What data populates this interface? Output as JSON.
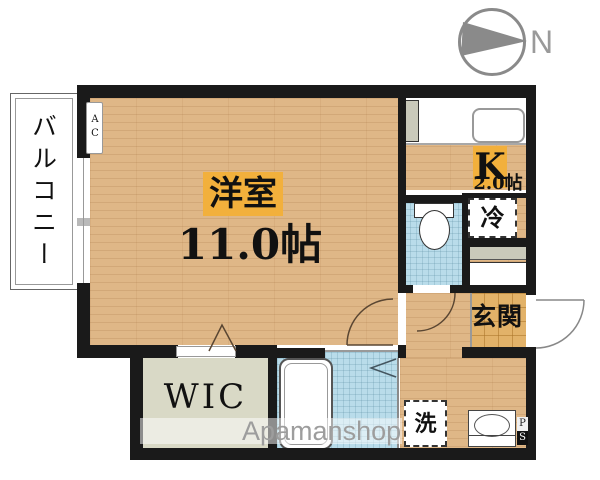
{
  "compass": {
    "north": "N"
  },
  "watermark": {
    "text": "Apamanshop"
  },
  "labels": {
    "balcony": "バルコニー",
    "ac_unit": "AC",
    "main_room_name": "洋室",
    "main_room_size": "11.0帖",
    "kitchen_name": "K",
    "kitchen_size": "2.0帖",
    "refrigerator": "冷",
    "entrance": "玄関",
    "wic": "WIC",
    "washer": "洗",
    "pipe_space_p": "P",
    "pipe_space_s": "S"
  },
  "colors": {
    "wood": "#dfb787",
    "tile": "#e2b269",
    "bath": "#b9dcea",
    "wic_floor": "#d9d9c6",
    "label_accent": "#f2b03c",
    "wall": "#1a1a1a",
    "watermark_gray": "#9d9d9d",
    "compass_gray": "#8a8a8a"
  }
}
